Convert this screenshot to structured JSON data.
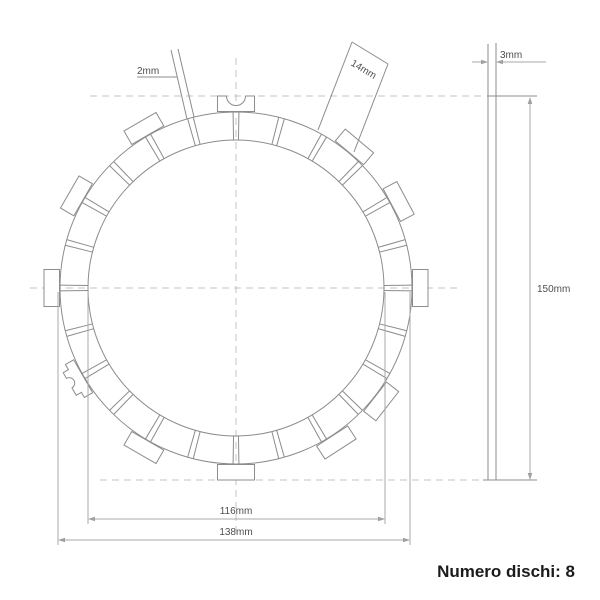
{
  "note": {
    "label": "Numero dischi: 8"
  },
  "dimensions": {
    "slot_width": {
      "label": "2mm"
    },
    "tab_width": {
      "label": "14mm"
    },
    "thickness": {
      "label": "3mm"
    },
    "overall_diameter": {
      "label": "150mm"
    },
    "inner_diameter": {
      "label": "116mm"
    },
    "friction_diameter": {
      "label": "138mm"
    }
  },
  "drawing": {
    "center": {
      "x": 236,
      "y": 288
    },
    "radius_inner": 148,
    "radius_pad_outer": 176,
    "tab_base_radius": 176.5,
    "tab_outer_radius": 192,
    "tab_half_width": 18.5,
    "slot_count": 24,
    "slot_step_deg": 15,
    "slot_half_angle_deg": 0.95,
    "tabs": [
      {
        "angle": 0,
        "variant": "outer-notch"
      },
      {
        "angle": 40,
        "variant": "plain"
      },
      {
        "angle": 62,
        "variant": "plain"
      },
      {
        "angle": 90,
        "variant": "plain"
      },
      {
        "angle": 128,
        "variant": "plain"
      },
      {
        "angle": 147,
        "variant": "plain"
      },
      {
        "angle": 180,
        "variant": "plain"
      },
      {
        "angle": 210,
        "variant": "plain"
      },
      {
        "angle": 240,
        "variant": "side-notch"
      },
      {
        "angle": 270,
        "variant": "plain"
      },
      {
        "angle": 300,
        "variant": "plain"
      },
      {
        "angle": 330,
        "variant": "plain"
      }
    ],
    "colors": {
      "line": "#8c8c8c",
      "dim_line": "#a8a8a8",
      "centerline": "#c3c3c3",
      "dim_text": "#4f4f4f",
      "note_text": "#1b1b1b",
      "background": "#ffffff"
    }
  }
}
